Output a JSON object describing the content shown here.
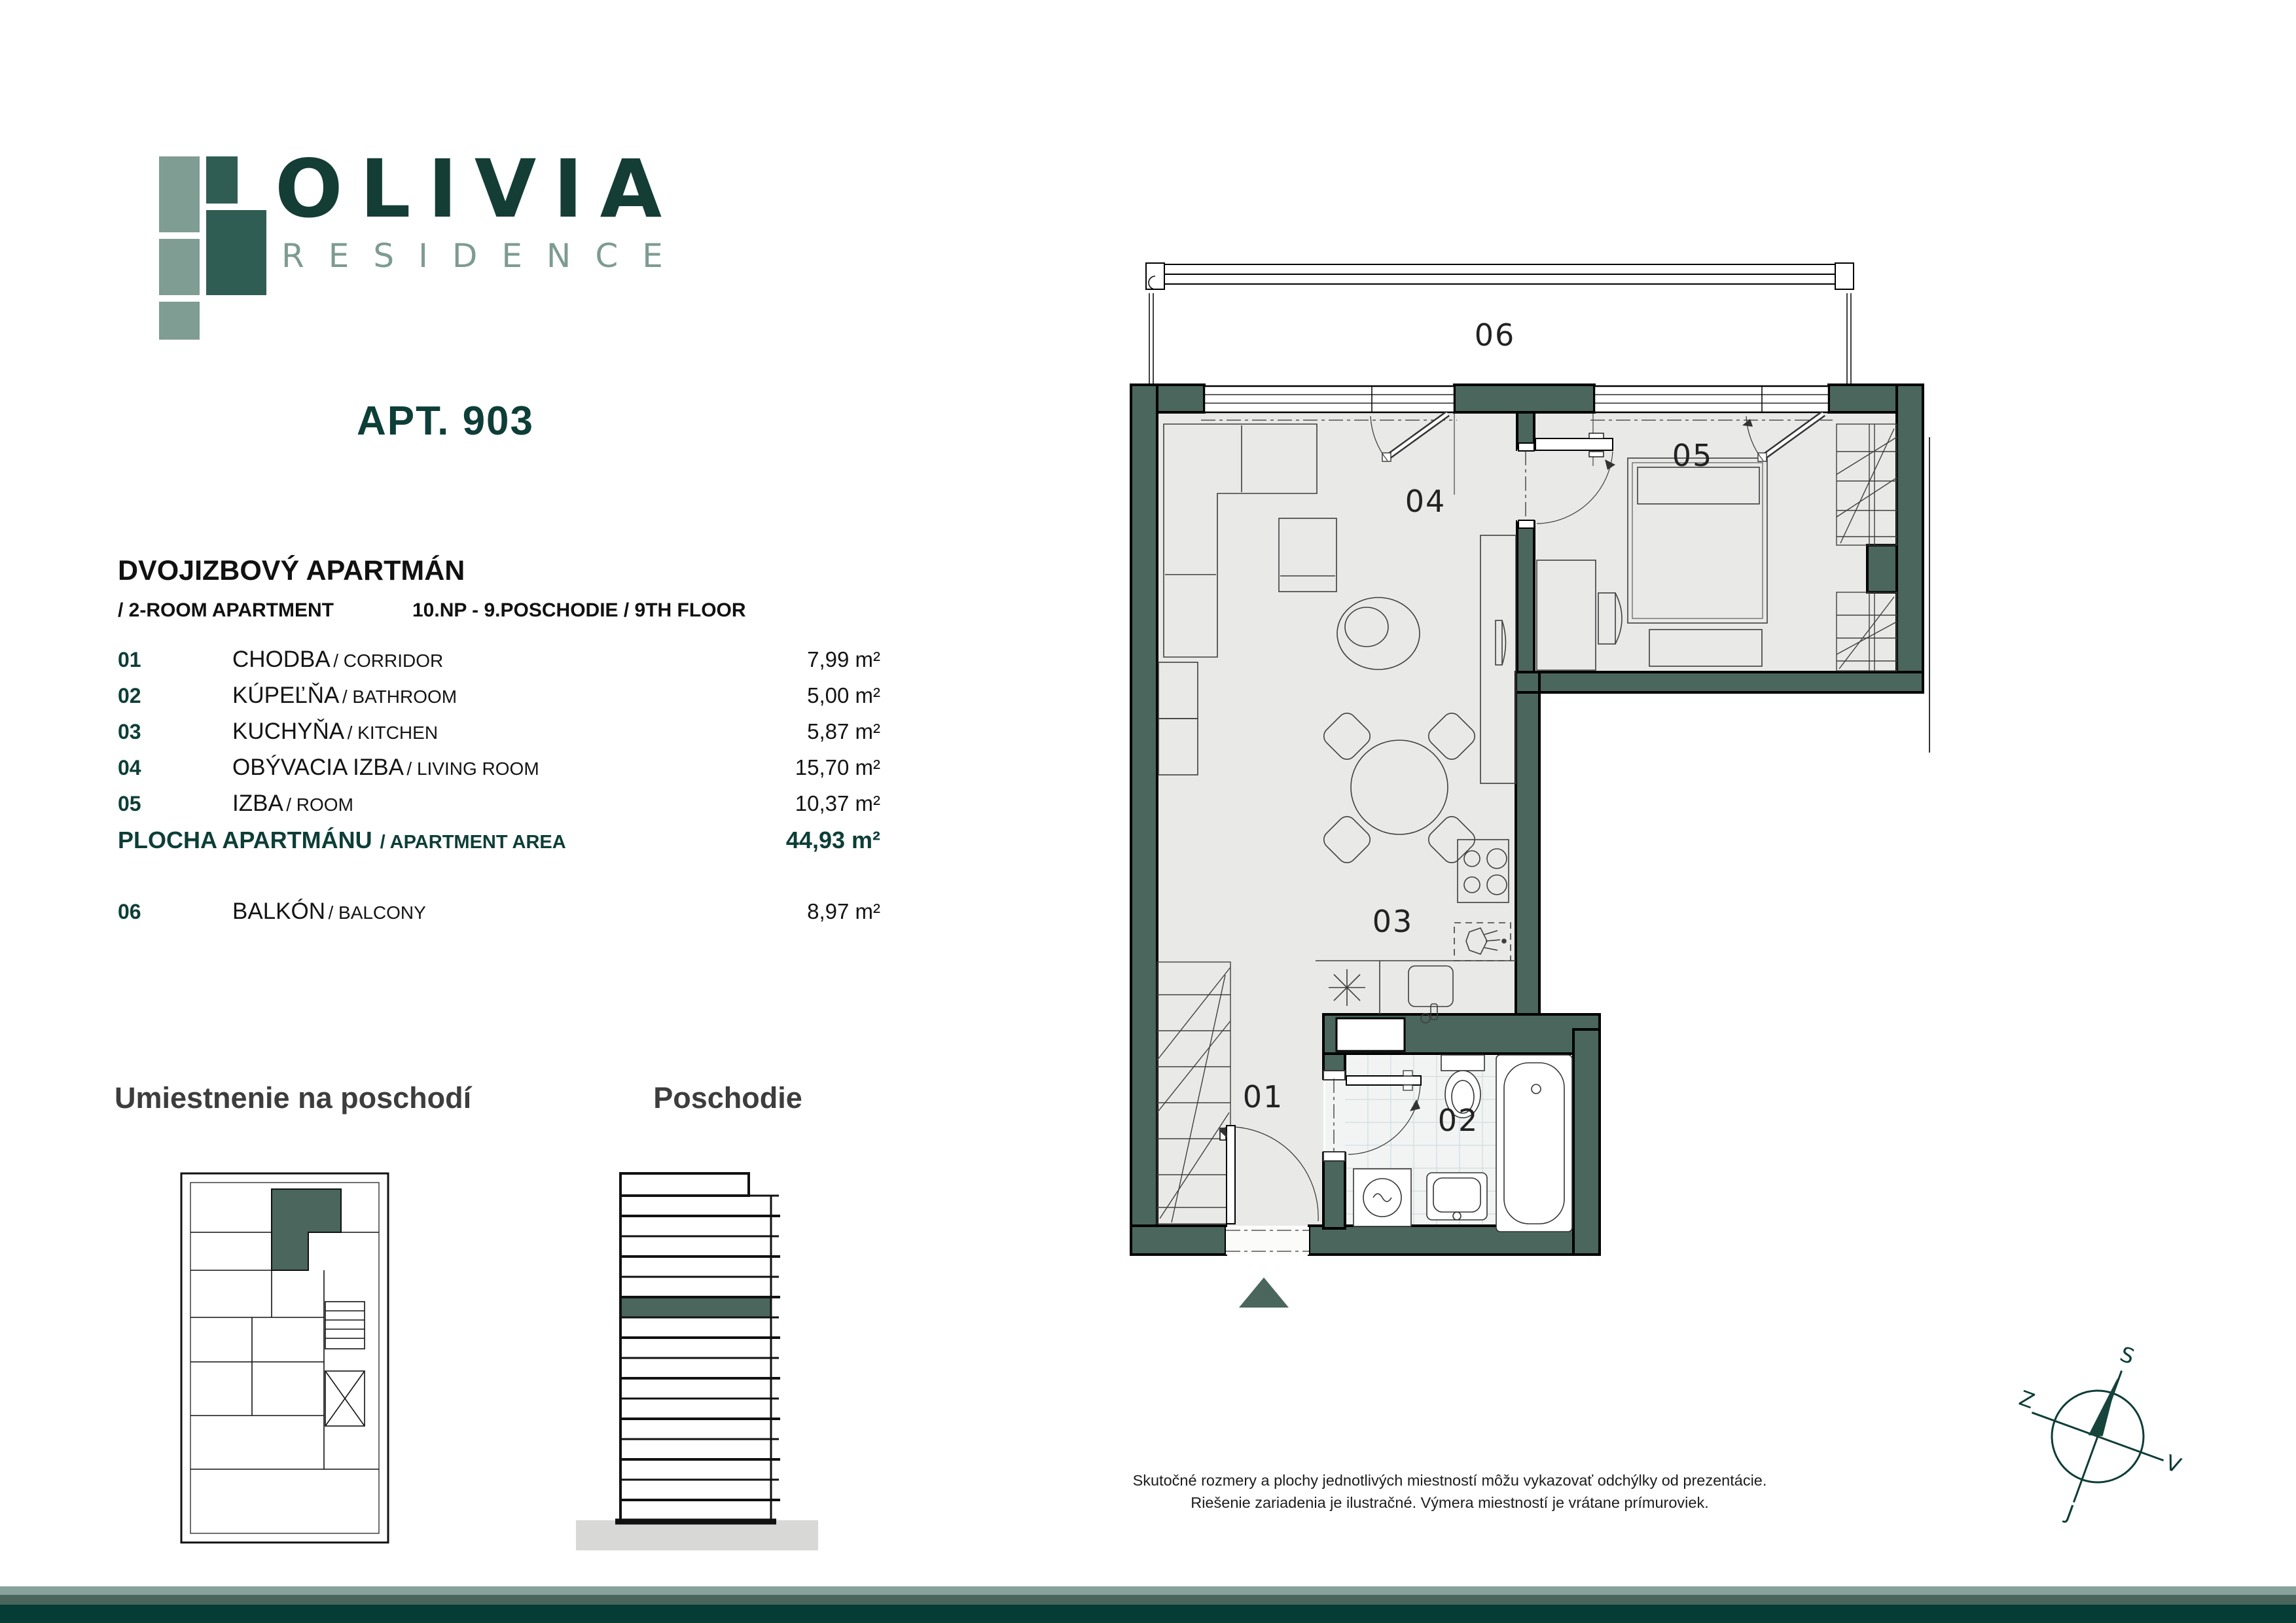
{
  "logo": {
    "title": "OLIVIA",
    "subtitle": "RESIDENCE"
  },
  "apartment": {
    "title": "APT. 903",
    "type_sk": "DVOJIZBOVÝ APARTMÁN",
    "type_en": "/ 2-ROOM APARTMENT",
    "floor_info": "10.NP - 9.POSCHODIE / 9TH FLOOR"
  },
  "rooms": [
    {
      "code": "01",
      "name_sk": "CHODBA",
      "name_en": "/ CORRIDOR",
      "area": "7,99 m²"
    },
    {
      "code": "02",
      "name_sk": "KÚPEĽŇA",
      "name_en": "/ BATHROOM",
      "area": "5,00 m²"
    },
    {
      "code": "03",
      "name_sk": "KUCHYŇA",
      "name_en": "/ KITCHEN",
      "area": "5,87 m²"
    },
    {
      "code": "04",
      "name_sk": "OBÝVACIA IZBA",
      "name_en": "/ LIVING ROOM",
      "area": "15,70 m²"
    },
    {
      "code": "05",
      "name_sk": "IZBA",
      "name_en": "/ ROOM",
      "area": "10,37 m²"
    }
  ],
  "total": {
    "label_sk": "PLOCHA APARTMÁNU",
    "label_en": "/ APARTMENT AREA",
    "area": "44,93 m²"
  },
  "balcony": {
    "code": "06",
    "name_sk": "BALKÓN",
    "name_en": "/ BALCONY",
    "area": "8,97 m²"
  },
  "sections": {
    "location_title": "Umiestnenie na poschodí",
    "floor_title": "Poschodie"
  },
  "plan": {
    "labels": {
      "r01": "01",
      "r02": "02",
      "r03": "03",
      "r04": "04",
      "r05": "05",
      "r06": "06"
    }
  },
  "compass": {
    "n": "S",
    "e": "V",
    "s": "J",
    "w": "Z"
  },
  "disclaimer": {
    "line1": "Skutočné rozmery a plochy jednotlivých miestností môžu vykazovať odchýlky od prezentácie.",
    "line2": "Riešenie zariadenia je ilustračné. Výmera miestností je vrátane prímuroviek."
  },
  "colors": {
    "accent_dark_teal": "#0d3e37",
    "wall_teal": "#4a665d",
    "sage": "#7e9b91",
    "floor_gray": "#e9e9e7",
    "footer_light": "#87a29a",
    "footer_mid": "#4a665c",
    "footer_dark": "#053c35"
  }
}
